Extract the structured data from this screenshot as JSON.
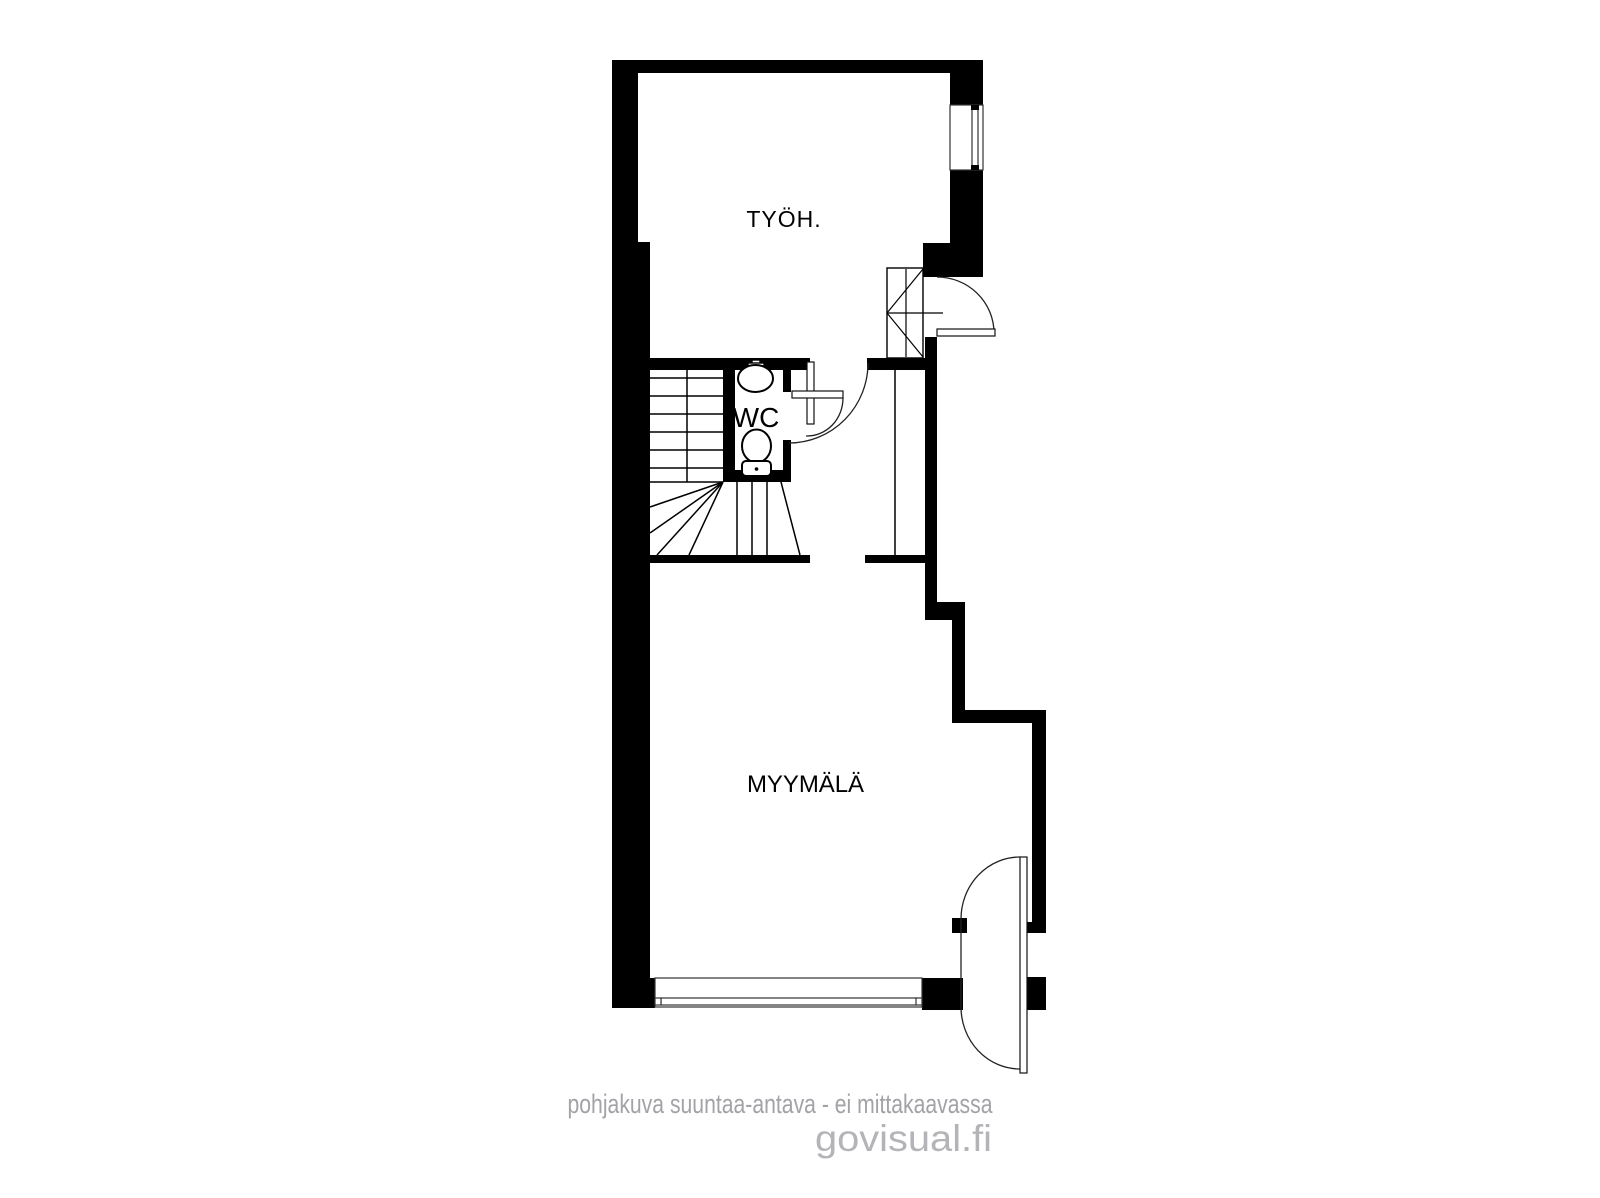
{
  "plan": {
    "type": "floor-plan",
    "rooms": [
      {
        "id": "tyoh",
        "label": "TYÖH."
      },
      {
        "id": "wc",
        "label": "WC"
      },
      {
        "id": "myymala",
        "label": "MYYMÄLÄ"
      }
    ],
    "fixtures": [
      "stairs",
      "sink",
      "toilet",
      "cabinet",
      "window",
      "storefront-window",
      "entry-door",
      "hall-door",
      "wc-door",
      "shop-double-door"
    ]
  },
  "footer": {
    "disclaimer": "pohjakuva suuntaa-antava - ei mittakaavassa",
    "watermark": "govisual.fi"
  },
  "colors": {
    "wall": "#000000",
    "background": "#ffffff",
    "label": "#000000",
    "disclaimer": "#a2a2a7",
    "watermark": "#b4b4b8"
  }
}
